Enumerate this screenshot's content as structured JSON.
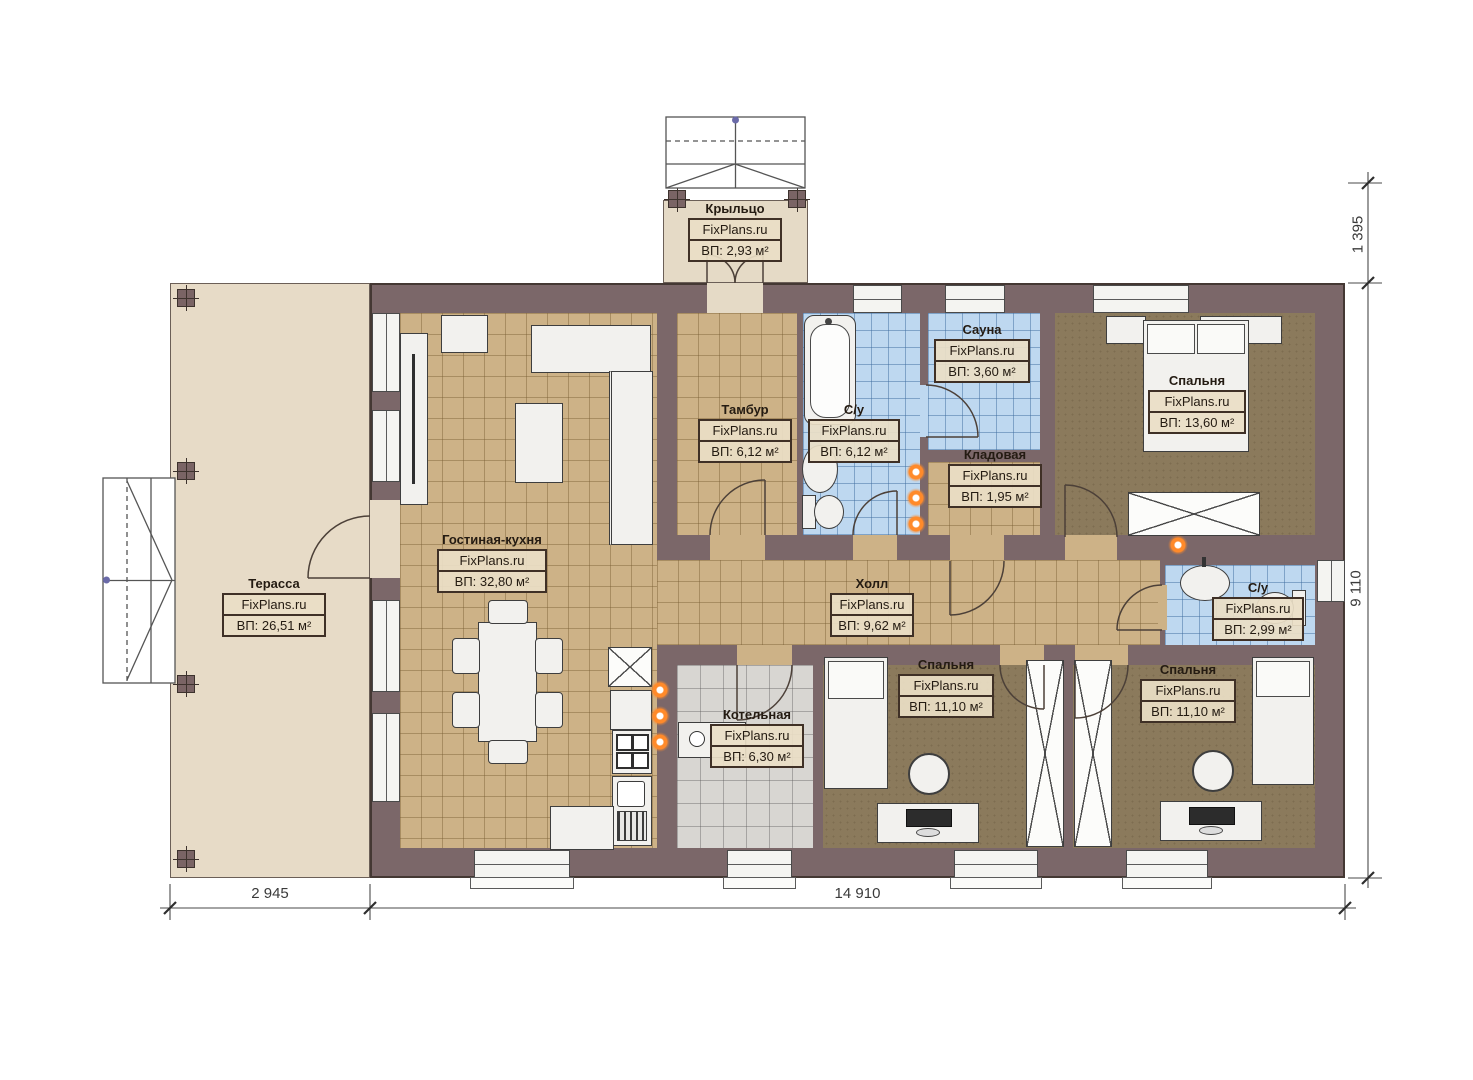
{
  "brand": "FixPlans.ru",
  "rooms": [
    {
      "name": "Крыльцо",
      "area": "ВП: 2,93 м²"
    },
    {
      "name": "Терасса",
      "area": "ВП: 26,51 м²"
    },
    {
      "name": "Гостиная-кухня",
      "area": "ВП: 32,80 м²"
    },
    {
      "name": "Тамбур",
      "area": "ВП: 6,12 м²"
    },
    {
      "name": "С/у",
      "area": "ВП: 6,12 м²"
    },
    {
      "name": "Сауна",
      "area": "ВП: 3,60 м²"
    },
    {
      "name": "Кладовая",
      "area": "ВП: 1,95 м²"
    },
    {
      "name": "Спальня",
      "area": "ВП: 13,60 м²"
    },
    {
      "name": "Холл",
      "area": "ВП: 9,62 м²"
    },
    {
      "name": "С/у",
      "area": "ВП: 2,99 м²"
    },
    {
      "name": "Котельная",
      "area": "ВП: 6,30 м²"
    },
    {
      "name": "Спальня",
      "area": "ВП: 11,10 м²"
    },
    {
      "name": "Спальня",
      "area": "ВП: 11,10 м²"
    }
  ],
  "dimensions": {
    "porch_offset": "1 395",
    "building_depth": "9 110",
    "terrace_width": "2 945",
    "building_width": "14 910"
  },
  "colors": {
    "wall": "#7b6769",
    "floor_tan": "#cdb287",
    "floor_blue": "#bed8f0",
    "floor_gray": "#d8d6d2",
    "floor_brown": "#8b7a5c",
    "terrace": "#e7dbc7",
    "flame_accent": "#ff8a2a"
  }
}
